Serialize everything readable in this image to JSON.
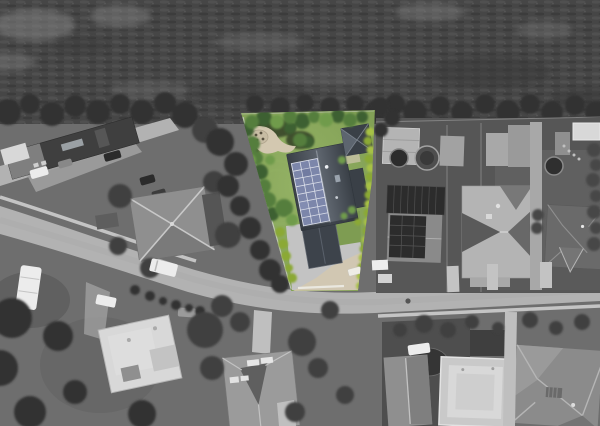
{
  "image": {
    "kind": "aerial drone photograph of a suburban neighborhood",
    "effect": "selective color: entire scene desaturated to grayscale except one featured property rendered in full color",
    "width_px": 600,
    "height_px": 426
  },
  "featured_property": {
    "label": "featured lot in color",
    "lot_shape": "wedge-shaped corner lot narrowing to the left",
    "elements": {
      "main_house": "dark slate gable-roof house",
      "solar_array": "rooftop photovoltaic array on west roof slope",
      "solar_panel_rows": 8,
      "solar_panel_columns": 3,
      "solar_panel_count": 24,
      "secondary_building": "small dark hip-roof building in north-east corner",
      "garage": "detached dark gable-roof garage at south end",
      "garden": "curved beige gravel path with round patio and shrubs in north-west corner",
      "lawn": "mowed green lawn",
      "hedge": "bright lime-green hedge along east boundary and lower west boundary",
      "driveway": "light concrete driveway with gate opening to the street"
    }
  },
  "surroundings": {
    "top": "grayscale scrub field with horizontal crop-row texture and tree line",
    "left": "long dark warehouse roof with parked cars, upper access road, hip-roof house with X ridges, white RV and vans",
    "right": "neighbouring yards: carport, two round tanks, house with its own solar panels, large pale hip-roof house, sheds, round pool, dark hip-roof house",
    "bottom": "curved street with sidewalks, street trees, dark garden with pond, gable house, white flat-roof houses, large hip-roof house"
  },
  "colors": {
    "ground_gray": "#6e6e6e",
    "ground_dark": "#565656",
    "ground_mid": "#606060",
    "field_base": "#464646",
    "field_row_light": "#5a5a5a",
    "field_row_dark": "#383838",
    "field_patch": "#858585",
    "tree_dark": "#333333",
    "tree_mid": "#414141",
    "tree_light": "#4f4f4f",
    "road": "#b2b2b2",
    "sidewalk": "#cdcdcd",
    "concrete": "#c3c3c3",
    "parking": "#9f9f9f",
    "roof_dark": "#3f3f3f",
    "roof_mid": "#8f8f8f",
    "roof_light": "#b4b4b4",
    "roof_shadow": "#6a6a6a",
    "ridge_light": "#c8c8c8",
    "building_white": "#d8d8d8",
    "vehicle_white": "#ececec",
    "vehicle_dark": "#2b2b2b",
    "solar_dark": "#2c2c2c",
    "lawn": "#7e9c52",
    "lawn_light": "#93b164",
    "tree_green_dark": "#3c6130",
    "tree_green": "#547e3d",
    "tree_green_light": "#6f9b4b",
    "hedge_lime": "#a7c144",
    "hedge_lime_dark": "#8ba934",
    "path_beige": "#d3c8b0",
    "patio_beige": "#c7bca3",
    "mulch": "#41502f",
    "slate_light": "#5d646d",
    "slate_dark": "#3a4047",
    "slate_ridge": "#858c95",
    "garage_roof": "#3d434b",
    "panel_blue": "#7c86aa",
    "panel_grid": "#d9dde8",
    "gate_white": "#eae8e0"
  }
}
